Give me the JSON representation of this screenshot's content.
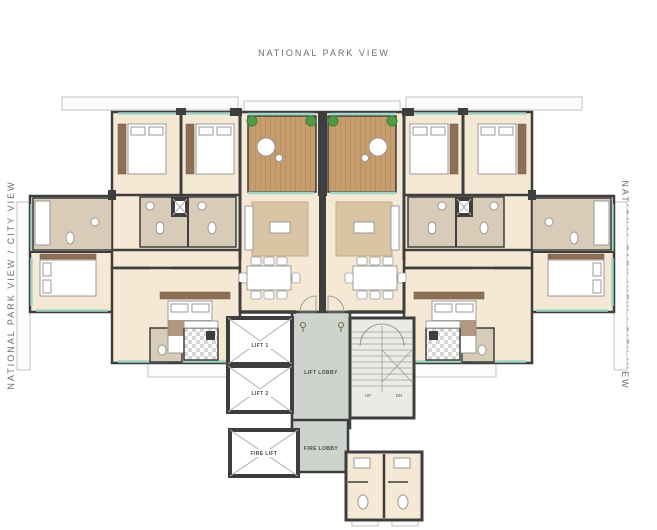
{
  "plan": {
    "type": "residential-tower-floor-plan",
    "orientation_labels": {
      "top": "NATIONAL PARK VIEW",
      "left": "NATIONAL PARK VIEW / CITY VIEW",
      "right": "NATIONAL PARK VIEW / CITY VIEW"
    }
  },
  "core": {
    "lift1": "LIFT 1",
    "lift2": "LIFT 2",
    "lift_lobby": "LIFT LOBBY",
    "fire_lift": "FIRE LIFT",
    "fire_lobby": "FIRE LOBBY",
    "stairs_up": "UP",
    "stairs_down": "DN"
  },
  "icons": {
    "plants": "plant-icon",
    "deck_seat": "round-chair-icon",
    "entry_markers": "door-pin-icon",
    "lift_cross": "lift-shaft-x-icon",
    "stair_cross": "stair-flight-x-icon"
  },
  "colors": {
    "wall": "#3e3e3e",
    "apartment_floor": "#f5e9d5",
    "deck_wood": "#c89d6e",
    "window_glass": "#9fd4c8",
    "lobby_floor": "#ced3cd",
    "stair_floor": "#ebebe6",
    "rug": "#d9c5a4",
    "bathroom_floor": "#d8cbb8",
    "wardrobe_wood": "#8d7055",
    "plant_green": "#4f9b45",
    "label_text": "#6e6e6e"
  }
}
